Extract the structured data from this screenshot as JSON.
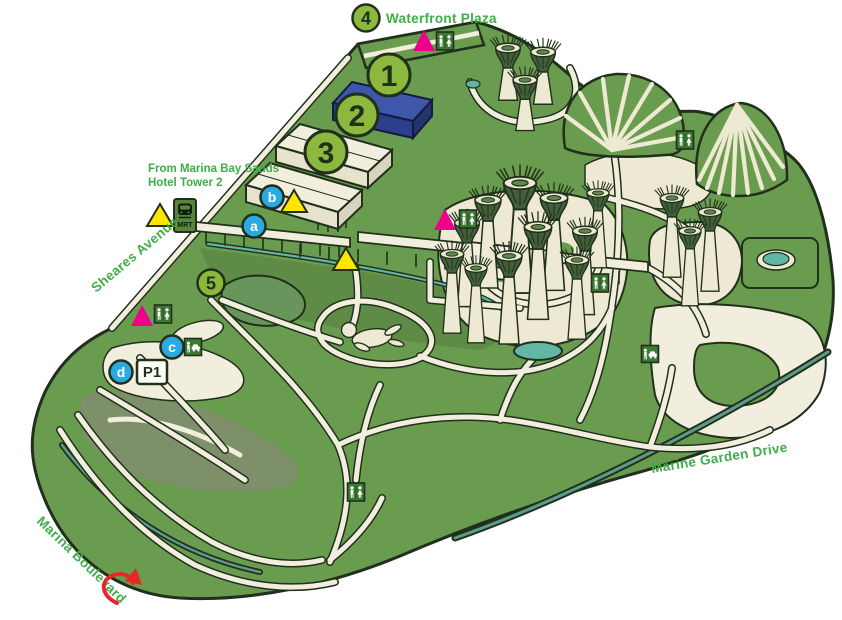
{
  "map": {
    "labels": {
      "waterfront_plaza": "Waterfront Plaza",
      "from_mbs_line1": "From Marina Bay Sands",
      "from_mbs_line2": "Hotel Tower 2",
      "sheares_avenue": "Sheares Avenue",
      "marine_garden_drive": "Marine Garden Drive",
      "marina_boulevard": "Marina Boulevard"
    },
    "signs": {
      "mrt": "MRT",
      "parking": "P1"
    },
    "numbered_markers": [
      {
        "number": "1"
      },
      {
        "number": "2"
      },
      {
        "number": "3"
      },
      {
        "number": "4"
      },
      {
        "number": "5"
      }
    ],
    "letter_markers": [
      {
        "letter": "a"
      },
      {
        "letter": "b"
      },
      {
        "letter": "c"
      },
      {
        "letter": "d"
      }
    ],
    "colors": {
      "park_green": "#6a9c4f",
      "shade_green": "#5e8c46",
      "lake_gray_green": "#7e9069",
      "path_cream": "#f2eedd",
      "outline": "#20301c",
      "marker_green": "#8cb83e",
      "marker_blue": "#29abe2",
      "triangle_magenta": "#ec008c",
      "triangle_yellow": "#ffe600",
      "icon_green": "#3c7a33",
      "water_teal": "#62b7a4",
      "building_blue": "#3f57ab",
      "label_green": "#3fae49",
      "arrow_red": "#e8262a"
    }
  }
}
